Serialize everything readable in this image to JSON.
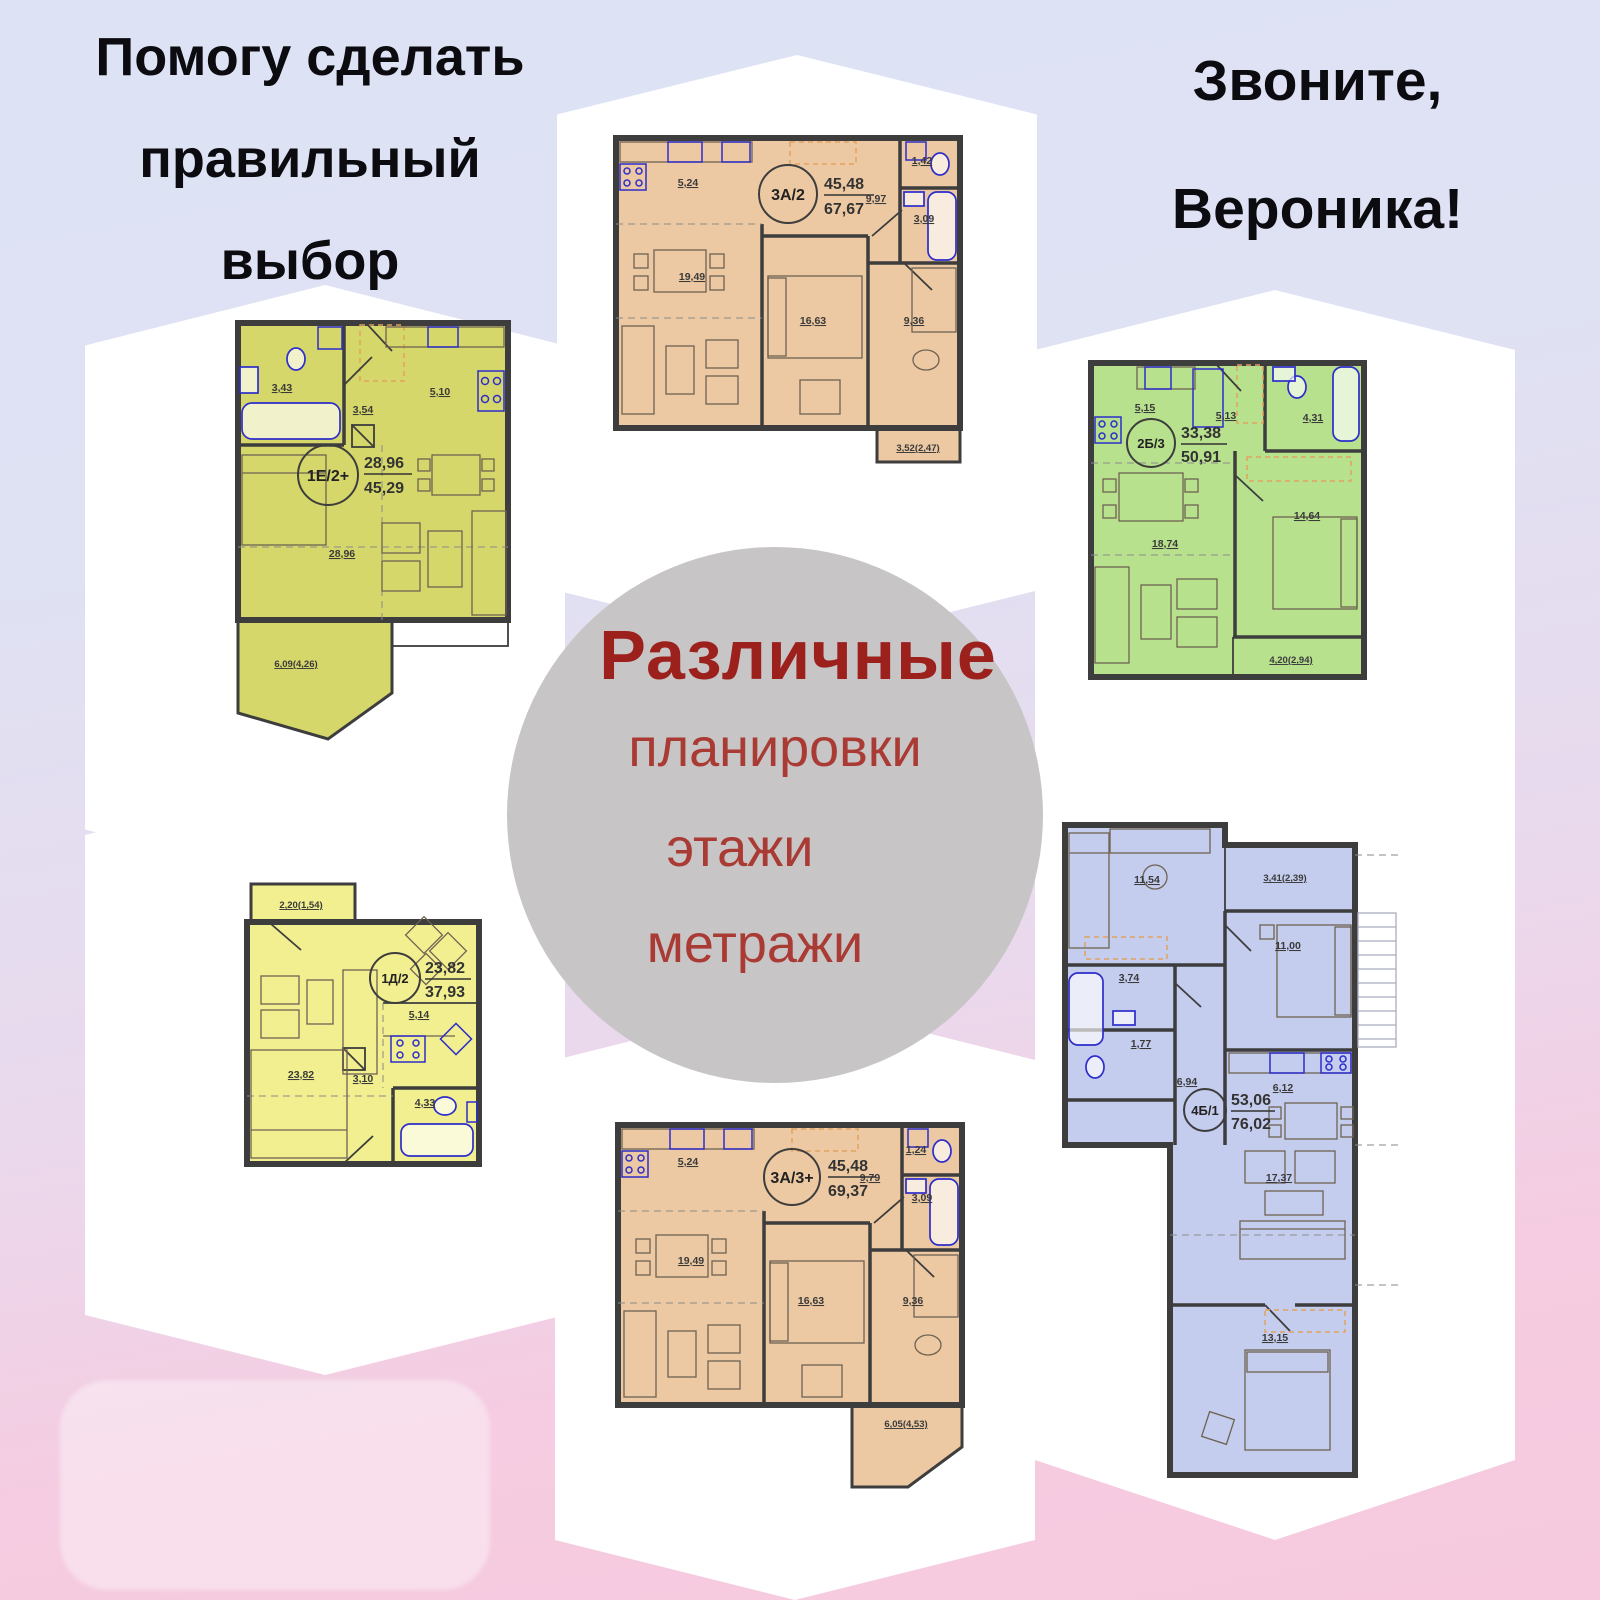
{
  "header_left": {
    "line1": "Помогу сделать",
    "line2": "правильный",
    "line3": "выбор"
  },
  "header_right": {
    "line1": "Звоните,",
    "line2": "Вероника!"
  },
  "center_badge": {
    "title": "Различные",
    "item1": "планировки",
    "item2": "этажи",
    "item3": "метражи"
  },
  "palette": {
    "bg_top": "#dde3f5",
    "bg_bottom": "#f6c9de",
    "tile": "#ffffff",
    "badge_bg": "#c8c5c6",
    "title_red": "#9c211c",
    "items_red": "#a93b34",
    "wall": "#3d3d3d",
    "fixture_blue": "#2d2dcb"
  },
  "plans": [
    {
      "code": "3А/2",
      "area_top": "45,48",
      "area_bottom": "67,67",
      "fill": "#ecc9a2",
      "m": {
        "kitchen": "5,24",
        "wc": "1,42",
        "hall": "9,97",
        "bath": "3,09",
        "living": "19,49",
        "bedroom1": "16,63",
        "bedroom2": "9,36",
        "balcony": "3,52(2,47)"
      }
    },
    {
      "code": "1Е/2+",
      "area_top": "28,96",
      "area_bottom": "45,29",
      "fill": "#d6d76a",
      "m": {
        "bath": "3,43",
        "hall": "3,54",
        "kitchen": "5,10",
        "living": "28,96",
        "balcony": "6,09(4,26)"
      }
    },
    {
      "code": "2Б/3",
      "area_top": "33,38",
      "area_bottom": "50,91",
      "fill": "#b8e18e",
      "m": {
        "kitchen": "5,15",
        "hall": "5,13",
        "bath": "4,31",
        "living": "18,74",
        "bedroom": "14,64",
        "balcony": "4,20(2,94)"
      }
    },
    {
      "code": "1Д/2",
      "area_top": "23,82",
      "area_bottom": "37,93",
      "fill": "#f2ef90",
      "m": {
        "balcony": "2,20(1,54)",
        "living": "23,82",
        "kitchen": "5,14",
        "hall": "3,10",
        "bath": "4,33"
      }
    },
    {
      "code": "3А/3+",
      "area_top": "45,48",
      "area_bottom": "69,37",
      "fill": "#ecc9a2",
      "m": {
        "kitchen": "5,24",
        "wc": "1,24",
        "hall": "9,79",
        "bath": "3,09",
        "living": "19,49",
        "bedroom1": "16,63",
        "bedroom2": "9,36",
        "balcony": "6,05(4,53)"
      }
    },
    {
      "code": "4Б/1",
      "area_top": "53,06",
      "area_bottom": "76,02",
      "fill": "#c5cdee",
      "m": {
        "room1": "11,54",
        "balcony": "3,41(2,39)",
        "bedroom1": "11,00",
        "bath": "3,74",
        "wc": "1,77",
        "hall": "6,94",
        "kitchen": "6,12",
        "living": "17,37",
        "bedroom2": "13,15"
      }
    }
  ]
}
